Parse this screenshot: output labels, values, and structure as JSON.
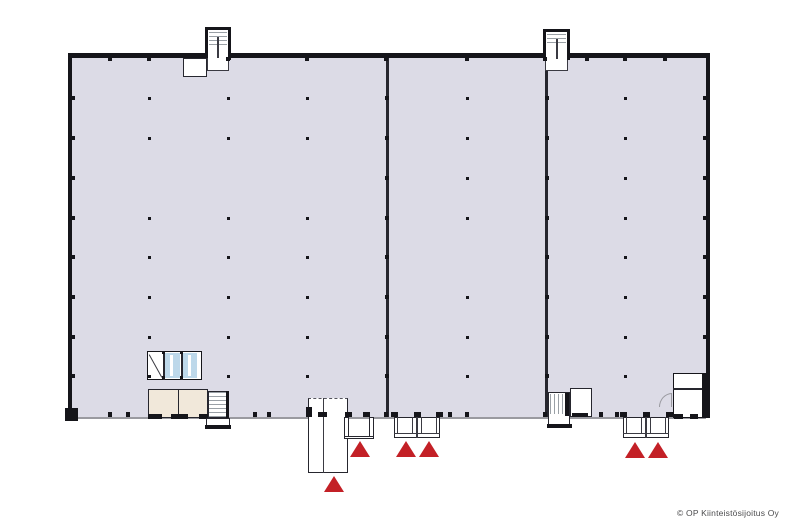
{
  "footer": {
    "copyright": "© OP Kiinteistösijoitus Oy"
  },
  "colors": {
    "wall": "#15151a",
    "wall2": "#26262e",
    "line": "#3a3a42",
    "floor": "#dcdbe6",
    "edge": "#9a9aa0",
    "beige": "#f1e8da",
    "blue": "#bdd8ea",
    "white": "#ffffff",
    "red": "#c32026",
    "text": "#4c4c4e"
  },
  "plan": {
    "shapes": [
      {
        "n": "floor-slab",
        "t": "rect",
        "x": 72,
        "y": 58,
        "w": 634,
        "h": 359,
        "f": "floor"
      },
      {
        "n": "floor-bottom-edge",
        "t": "rect",
        "x": 72,
        "y": 417,
        "w": 634,
        "h": 1.5,
        "f": "edge"
      },
      {
        "n": "wall-top",
        "t": "rect",
        "x": 68,
        "y": 53,
        "w": 642,
        "h": 5,
        "f": "wall"
      },
      {
        "n": "wall-left",
        "t": "rect",
        "x": 68,
        "y": 53,
        "w": 4,
        "h": 368,
        "f": "wall"
      },
      {
        "n": "wall-right",
        "t": "rect",
        "x": 706,
        "y": 53,
        "w": 4,
        "h": 365,
        "f": "wall"
      },
      {
        "n": "wall-corner-bl",
        "t": "rect",
        "x": 65,
        "y": 408,
        "w": 13,
        "h": 13,
        "f": "wall"
      },
      {
        "n": "divider-wall-west",
        "t": "rect",
        "x": 386,
        "y": 58,
        "w": 3,
        "h": 359,
        "f": "wall2"
      },
      {
        "n": "divider-wall-east",
        "t": "rect",
        "x": 545,
        "y": 58,
        "w": 3,
        "h": 359,
        "f": "wall2"
      },
      {
        "n": "stair-tower-north-a-shell",
        "t": "rect",
        "x": 205,
        "y": 27,
        "w": 26,
        "h": 33,
        "f": "wall"
      },
      {
        "n": "stair-tower-north-a-interior",
        "t": "rect",
        "x": 208,
        "y": 30,
        "w": 20,
        "h": 41,
        "f": "white"
      },
      {
        "n": "stair-tower-north-a-treads",
        "t": "rect",
        "x": 209,
        "y": 32,
        "w": 18,
        "h": 14,
        "c": "treads-h"
      },
      {
        "n": "stair-tower-north-a-rail",
        "t": "rect",
        "x": 217,
        "y": 37,
        "w": 1.5,
        "h": 21,
        "f": "line"
      },
      {
        "n": "stair-tower-north-a-side-l",
        "t": "rect",
        "x": 207,
        "y": 58,
        "w": 1,
        "h": 13,
        "f": "line"
      },
      {
        "n": "stair-tower-north-a-side-r",
        "t": "rect",
        "x": 228,
        "y": 58,
        "w": 1,
        "h": 13,
        "f": "line"
      },
      {
        "n": "stair-tower-north-a-bottom",
        "t": "rect",
        "x": 207,
        "y": 70,
        "w": 22,
        "h": 1,
        "f": "line"
      },
      {
        "n": "vestibule-north-a",
        "t": "rect",
        "x": 183,
        "y": 58,
        "w": 24,
        "h": 19,
        "f": "white",
        "bd": "1px solid #26262e"
      },
      {
        "n": "stair-tower-north-b-shell",
        "t": "rect",
        "x": 543,
        "y": 29,
        "w": 27,
        "h": 31,
        "f": "wall"
      },
      {
        "n": "stair-tower-north-b-interior",
        "t": "rect",
        "x": 546,
        "y": 32,
        "w": 21,
        "h": 39,
        "f": "white"
      },
      {
        "n": "stair-tower-north-b-treads",
        "t": "rect",
        "x": 547,
        "y": 34,
        "w": 19,
        "h": 12,
        "c": "treads-h"
      },
      {
        "n": "stair-tower-north-b-rail",
        "t": "rect",
        "x": 556,
        "y": 39,
        "w": 1.5,
        "h": 20,
        "f": "line"
      },
      {
        "n": "stair-tower-north-b-side-l",
        "t": "rect",
        "x": 545,
        "y": 60,
        "w": 1,
        "h": 11,
        "f": "line"
      },
      {
        "n": "stair-tower-north-b-side-r",
        "t": "rect",
        "x": 567,
        "y": 60,
        "w": 1,
        "h": 11,
        "f": "line"
      },
      {
        "n": "stair-tower-north-b-bottom",
        "t": "rect",
        "x": 545,
        "y": 70,
        "w": 23,
        "h": 1,
        "f": "line"
      },
      {
        "n": "wc-block",
        "t": "rect",
        "x": 147,
        "y": 351,
        "w": 55,
        "h": 29,
        "f": "white",
        "bd": "1.5px solid #15151a"
      },
      {
        "n": "wc-cell-blue-1",
        "t": "rect",
        "x": 164,
        "y": 353,
        "w": 16,
        "h": 25,
        "f": "blue"
      },
      {
        "n": "wc-cell-blue-2",
        "t": "rect",
        "x": 182,
        "y": 353,
        "w": 15,
        "h": 25,
        "f": "blue"
      },
      {
        "n": "wc-stripe-1",
        "t": "rect",
        "x": 170,
        "y": 355,
        "w": 3,
        "h": 21,
        "f": "white"
      },
      {
        "n": "wc-stripe-2",
        "t": "rect",
        "x": 188,
        "y": 355,
        "w": 3,
        "h": 21,
        "f": "white"
      },
      {
        "n": "wc-partition-1",
        "t": "rect",
        "x": 163,
        "y": 351,
        "w": 1.5,
        "h": 29,
        "f": "wall2"
      },
      {
        "n": "wc-partition-2",
        "t": "rect",
        "x": 181,
        "y": 351,
        "w": 1.5,
        "h": 29,
        "f": "wall2"
      },
      {
        "n": "wc-door-diagonal",
        "t": "rect",
        "x": 155,
        "y": 353,
        "w": 1,
        "h": 26,
        "f": "line",
        "rot": -29
      },
      {
        "n": "wc-hinge",
        "t": "rect",
        "x": 162,
        "y": 351,
        "w": 3,
        "h": 3,
        "f": "wall"
      },
      {
        "n": "wc-hinge",
        "t": "rect",
        "x": 162,
        "y": 376,
        "w": 3,
        "h": 3,
        "f": "wall"
      },
      {
        "n": "wc-hinge",
        "t": "rect",
        "x": 180,
        "y": 351,
        "w": 3,
        "h": 3,
        "f": "wall"
      },
      {
        "n": "wc-hinge",
        "t": "rect",
        "x": 180,
        "y": 376,
        "w": 3,
        "h": 3,
        "f": "wall"
      },
      {
        "n": "office-room-left",
        "t": "rect",
        "x": 148,
        "y": 389,
        "w": 31,
        "h": 29,
        "f": "beige",
        "bd": "1px solid #26262e"
      },
      {
        "n": "office-room-right",
        "t": "rect",
        "x": 178,
        "y": 389,
        "w": 30,
        "h": 29,
        "f": "beige",
        "bd": "1px solid #26262e"
      },
      {
        "n": "office-wall-seg",
        "t": "rect",
        "x": 148,
        "y": 414,
        "w": 14,
        "h": 5,
        "f": "wall"
      },
      {
        "n": "office-wall-seg",
        "t": "rect",
        "x": 171,
        "y": 414,
        "w": 17,
        "h": 5,
        "f": "wall"
      },
      {
        "n": "office-wall-seg",
        "t": "rect",
        "x": 199,
        "y": 414,
        "w": 9,
        "h": 5,
        "f": "wall"
      },
      {
        "n": "stair-southwest-shell",
        "t": "rect",
        "x": 208,
        "y": 391,
        "w": 20,
        "h": 27,
        "f": "white",
        "bd": "1px solid #26262e"
      },
      {
        "n": "stair-southwest-treads",
        "t": "rect",
        "x": 209,
        "y": 392,
        "w": 18,
        "h": 25,
        "c": "treads-h"
      },
      {
        "n": "stair-southwest-wall-r",
        "t": "rect",
        "x": 226,
        "y": 391,
        "w": 3,
        "h": 28,
        "f": "wall"
      },
      {
        "n": "stair-southwest-porch",
        "t": "rect",
        "x": 206,
        "y": 418,
        "w": 24,
        "h": 8,
        "f": "white",
        "bd": "1px solid #26262e"
      },
      {
        "n": "stair-southwest-porch-bottom",
        "t": "rect",
        "x": 205,
        "y": 425,
        "w": 26,
        "h": 4,
        "f": "wall"
      },
      {
        "n": "entrance-canopy",
        "t": "rect",
        "x": 308,
        "y": 398,
        "w": 40,
        "h": 75,
        "f": "white",
        "bd": "1px solid #26262e",
        "c": "dash-top"
      },
      {
        "n": "entrance-canopy-divider",
        "t": "rect",
        "x": 323,
        "y": 398,
        "w": 1,
        "h": 75,
        "f": "line"
      },
      {
        "n": "entrance-canopy-jamb",
        "t": "rect",
        "x": 306,
        "y": 407,
        "w": 6,
        "h": 10,
        "f": "wall"
      },
      {
        "n": "entrance-canopy-tick",
        "t": "rect",
        "x": 318,
        "y": 412,
        "w": 9,
        "h": 5,
        "f": "wall"
      },
      {
        "n": "dock-rail",
        "t": "rect",
        "x": 344,
        "y": 417,
        "w": 5,
        "h": 20,
        "f": "white",
        "bd": "1px solid #26262e"
      },
      {
        "n": "dock-rail",
        "t": "rect",
        "x": 369,
        "y": 417,
        "w": 5,
        "h": 20,
        "f": "white",
        "bd": "1px solid #26262e"
      },
      {
        "n": "dock-base",
        "t": "rect",
        "x": 344,
        "y": 436,
        "w": 30,
        "h": 3,
        "f": "white",
        "bd": "1px solid #26262e"
      },
      {
        "n": "dock-jamb",
        "t": "rect",
        "x": 345,
        "y": 412,
        "w": 7,
        "h": 5,
        "f": "wall"
      },
      {
        "n": "dock-jamb",
        "t": "rect",
        "x": 363,
        "y": 412,
        "w": 7,
        "h": 5,
        "f": "wall"
      },
      {
        "n": "dock-pair-center",
        "t": "rect",
        "x": 394,
        "y": 417,
        "w": 46,
        "h": 21,
        "f": "white",
        "bd": "1px solid #26262e"
      },
      {
        "n": "dock-divider",
        "t": "rect",
        "x": 416,
        "y": 417,
        "w": 1.5,
        "h": 21,
        "f": "line"
      },
      {
        "n": "dock-step-line",
        "t": "rect",
        "x": 394,
        "y": 433,
        "w": 46,
        "h": 1,
        "f": "line"
      },
      {
        "n": "dock-inner-rail",
        "t": "rect",
        "x": 397,
        "y": 417,
        "w": 1,
        "h": 16,
        "f": "line"
      },
      {
        "n": "dock-inner-rail",
        "t": "rect",
        "x": 412,
        "y": 417,
        "w": 1,
        "h": 16,
        "f": "line"
      },
      {
        "n": "dock-inner-rail",
        "t": "rect",
        "x": 421,
        "y": 417,
        "w": 1,
        "h": 16,
        "f": "line"
      },
      {
        "n": "dock-inner-rail",
        "t": "rect",
        "x": 436,
        "y": 417,
        "w": 1,
        "h": 16,
        "f": "line"
      },
      {
        "n": "dock-jamb",
        "t": "rect",
        "x": 391,
        "y": 412,
        "w": 7,
        "h": 5,
        "f": "wall"
      },
      {
        "n": "dock-jamb",
        "t": "rect",
        "x": 414,
        "y": 412,
        "w": 7,
        "h": 5,
        "f": "wall"
      },
      {
        "n": "dock-jamb",
        "t": "rect",
        "x": 436,
        "y": 412,
        "w": 7,
        "h": 5,
        "f": "wall"
      },
      {
        "n": "dock-pair-east",
        "t": "rect",
        "x": 623,
        "y": 417,
        "w": 46,
        "h": 21,
        "f": "white",
        "bd": "1px solid #26262e"
      },
      {
        "n": "dock-divider",
        "t": "rect",
        "x": 645,
        "y": 417,
        "w": 1.5,
        "h": 21,
        "f": "line"
      },
      {
        "n": "dock-step-line",
        "t": "rect",
        "x": 623,
        "y": 433,
        "w": 46,
        "h": 1,
        "f": "line"
      },
      {
        "n": "dock-inner-rail",
        "t": "rect",
        "x": 626,
        "y": 417,
        "w": 1,
        "h": 16,
        "f": "line"
      },
      {
        "n": "dock-inner-rail",
        "t": "rect",
        "x": 641,
        "y": 417,
        "w": 1,
        "h": 16,
        "f": "line"
      },
      {
        "n": "dock-inner-rail",
        "t": "rect",
        "x": 650,
        "y": 417,
        "w": 1,
        "h": 16,
        "f": "line"
      },
      {
        "n": "dock-inner-rail",
        "t": "rect",
        "x": 665,
        "y": 417,
        "w": 1,
        "h": 16,
        "f": "line"
      },
      {
        "n": "dock-jamb",
        "t": "rect",
        "x": 620,
        "y": 412,
        "w": 7,
        "h": 5,
        "f": "wall"
      },
      {
        "n": "dock-jamb",
        "t": "rect",
        "x": 643,
        "y": 412,
        "w": 7,
        "h": 5,
        "f": "wall"
      },
      {
        "n": "dock-jamb",
        "t": "rect",
        "x": 666,
        "y": 412,
        "w": 7,
        "h": 5,
        "f": "wall"
      },
      {
        "n": "stair-southeast-shell",
        "t": "rect",
        "x": 548,
        "y": 392,
        "w": 22,
        "h": 36,
        "f": "white",
        "bd": "1px solid #26262e"
      },
      {
        "n": "stair-southeast-treads",
        "t": "rect",
        "x": 550,
        "y": 394,
        "w": 14,
        "h": 20,
        "c": "treads-v"
      },
      {
        "n": "stair-southeast-wall-r",
        "t": "rect",
        "x": 565,
        "y": 393,
        "w": 4,
        "h": 23,
        "f": "wall"
      },
      {
        "n": "stair-southeast-bottom",
        "t": "rect",
        "x": 547,
        "y": 424,
        "w": 25,
        "h": 4,
        "f": "wall"
      },
      {
        "n": "room-southeast",
        "t": "rect",
        "x": 570,
        "y": 388,
        "w": 22,
        "h": 29,
        "f": "white",
        "bd": "1px solid #26262e"
      },
      {
        "n": "room-southeast-wall-seg",
        "t": "rect",
        "x": 572,
        "y": 413,
        "w": 16,
        "h": 4,
        "f": "wall"
      },
      {
        "n": "door-swing-arc",
        "t": "rect",
        "x": 659,
        "y": 393,
        "w": 13,
        "h": 14,
        "c": "arc"
      },
      {
        "n": "door-leaf",
        "t": "rect",
        "x": 671,
        "y": 393,
        "w": 1,
        "h": 14,
        "f": "edge"
      },
      {
        "n": "corner-room",
        "t": "rect",
        "x": 673,
        "y": 373,
        "w": 33,
        "h": 45,
        "f": "white",
        "bd": "1px solid #15151a"
      },
      {
        "n": "corner-room-divider",
        "t": "rect",
        "x": 673,
        "y": 388,
        "w": 33,
        "h": 2,
        "f": "wall2"
      },
      {
        "n": "corner-room-wall-r",
        "t": "rect",
        "x": 702,
        "y": 373,
        "w": 5,
        "h": 45,
        "f": "wall"
      },
      {
        "n": "corner-room-wall-seg",
        "t": "rect",
        "x": 674,
        "y": 414,
        "w": 9,
        "h": 5,
        "f": "wall"
      },
      {
        "n": "corner-room-wall-seg",
        "t": "rect",
        "x": 690,
        "y": 414,
        "w": 8,
        "h": 5,
        "f": "wall"
      }
    ],
    "grid": {
      "rows": [
        98,
        138,
        178,
        218,
        257,
        297,
        337,
        376
      ],
      "free_columns": [
        {
          "x": 149,
          "skip_rows": [
            178
          ]
        },
        {
          "x": 228,
          "skip_rows": [
            178
          ]
        },
        {
          "x": 307,
          "skip_rows": [
            178
          ]
        },
        {
          "x": 467,
          "skip_rows": [
            257
          ]
        },
        {
          "x": 625,
          "skip_rows": []
        }
      ],
      "wall_columns": [
        {
          "x": 71
        },
        {
          "x": 385
        },
        {
          "x": 545
        },
        {
          "x": 703
        }
      ],
      "top_ticks": [
        110,
        149,
        228,
        307,
        386,
        467,
        545,
        587,
        625,
        665
      ],
      "bottom_ticks": [
        110,
        128,
        255,
        269,
        386,
        450,
        467,
        545,
        601,
        617
      ],
      "dot_size": 3,
      "mark_size": 4
    },
    "entrances": [
      {
        "cx": 334,
        "y": 476
      },
      {
        "cx": 360,
        "y": 441
      },
      {
        "cx": 406,
        "y": 441
      },
      {
        "cx": 429,
        "y": 441
      },
      {
        "cx": 635,
        "y": 442
      },
      {
        "cx": 658,
        "y": 442
      }
    ]
  }
}
